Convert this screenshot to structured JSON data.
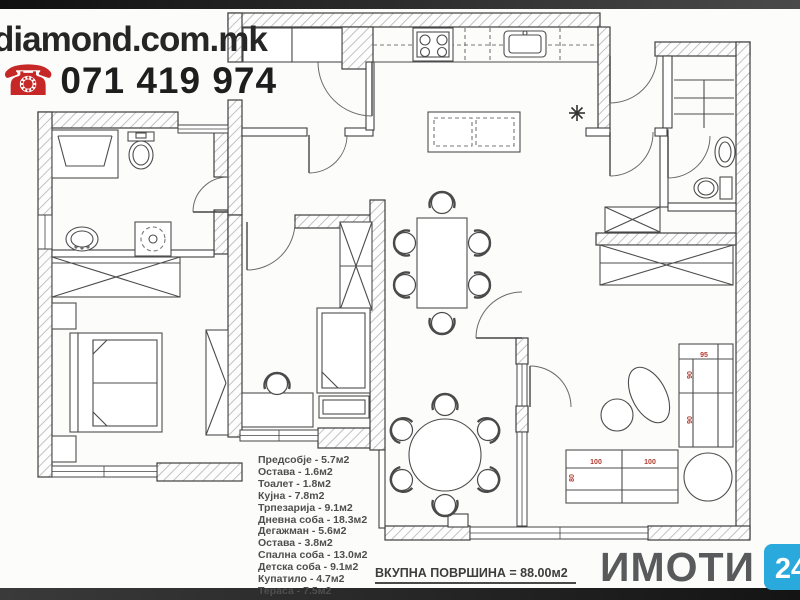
{
  "branding": {
    "website": "diamond.com.mk",
    "phone": "071 419 974",
    "phone_icon_color": "#c62828"
  },
  "rooms": {
    "items": [
      "Предсобје - 5.7м2",
      "Остава - 1.6м2",
      "Тоалет - 1.8м2",
      "Кујна - 7.8m2",
      "Трпезарија - 9.1м2",
      "Дневна соба - 18.3м2",
      "Дегажман - 5.6м2",
      "Остава - 3.8м2",
      "Спална соба - 13.0м2",
      "Детска соба - 9.1м2",
      "Купатило - 4.7м2",
      "Тераса - 7.5м2"
    ]
  },
  "total_area_label": "ВКУПНА ПОВРШИНА = 88.00м2",
  "logo": {
    "name": "ИМОТИ",
    "badge_left": "24",
    "badge_right": "7",
    "left_color": "#2aa9dc",
    "right_color": "#f58220",
    "text_color": "#595a5c"
  },
  "plan": {
    "dims": [
      "95",
      "90",
      "90",
      "100",
      "100",
      "80"
    ],
    "dim_color": "#b03a2e"
  }
}
